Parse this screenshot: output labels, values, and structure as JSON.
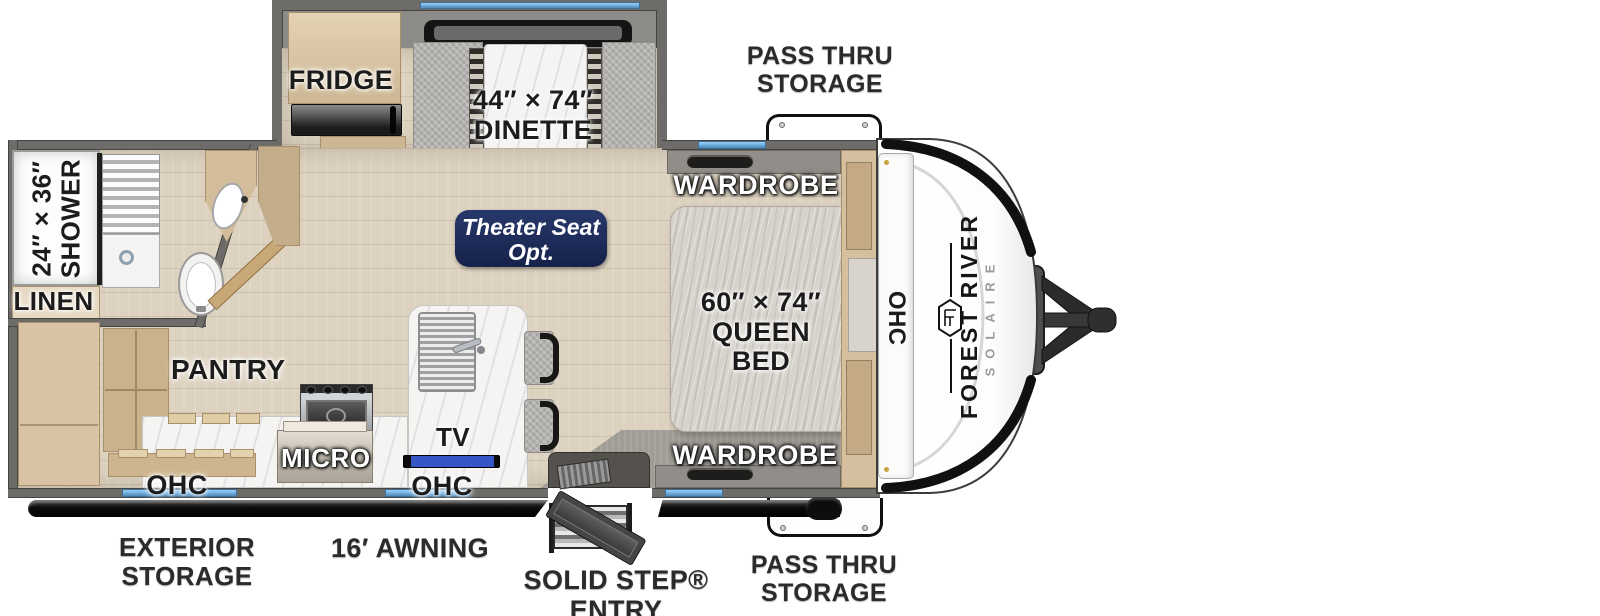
{
  "colors": {
    "wall_gray": "#6e6c69",
    "floor_tan": "#ddd2c0",
    "accent_blue": "#74b3e3",
    "badge_navy": "#1c2a57",
    "awning_black": "#0d0d0d",
    "cap_white": "#ffffff"
  },
  "branding": {
    "make": "FOREST RIVER",
    "model": "SOLAIRE"
  },
  "labels": {
    "pass_thru_top": {
      "line1": "PASS THRU",
      "line2": "STORAGE"
    },
    "fridge": "FRIDGE",
    "dinette": {
      "line1": "44″ × 74″",
      "line2": "DINETTE"
    },
    "shower": {
      "line1": "24″ × 36″",
      "line2": "SHOWER"
    },
    "linen": "LINEN",
    "theater": {
      "line1": "Theater Seat",
      "line2": "Opt."
    },
    "wardrobe_top": "WARDROBE",
    "wardrobe_bottom": "WARDROBE",
    "queen_bed": {
      "line1": "60″ × 74″",
      "line2": "QUEEN BED"
    },
    "ohc_front": "OHC",
    "pantry": "PANTRY",
    "micro": "MICRO",
    "tv": "TV",
    "ohc_kitchen_left": "OHC",
    "ohc_kitchen_mid": "OHC",
    "exterior_storage": {
      "line1": "EXTERIOR",
      "line2": "STORAGE"
    },
    "awning": "16′ AWNING",
    "entry": "SOLID STEP® ENTRY",
    "pass_thru_bottom": {
      "line1": "PASS THRU",
      "line2": "STORAGE"
    }
  }
}
